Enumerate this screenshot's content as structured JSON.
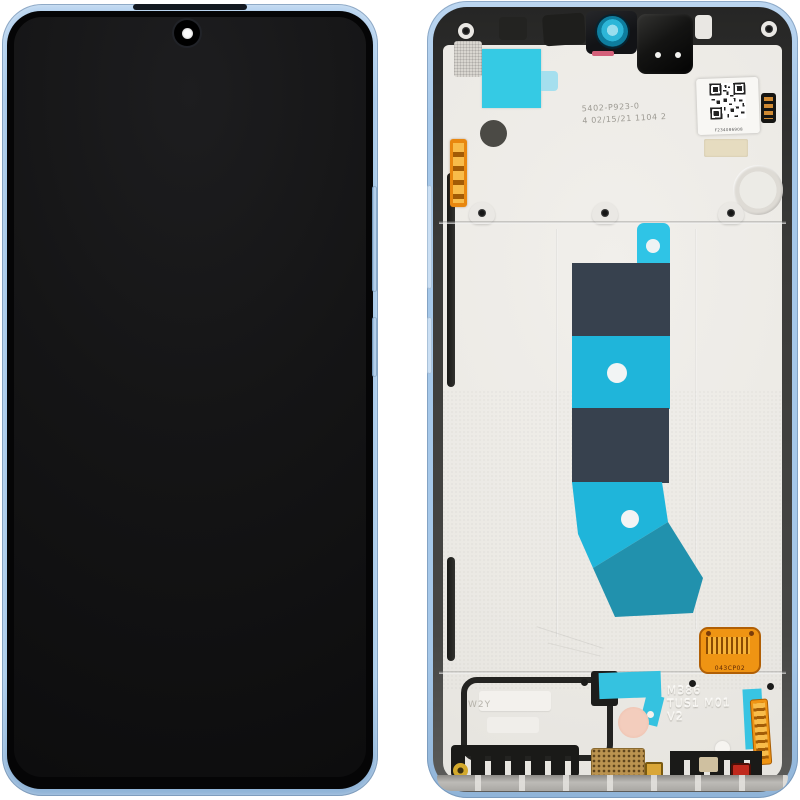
{
  "product": {
    "markings": {
      "etched_line1": "5402-P923-0",
      "etched_line2": "4 02/15/21 1104 2",
      "frame_code_line1": "M386",
      "frame_code_line2": "TUS1 M01",
      "frame_code_line3": "V2",
      "flex_code": "043CP02",
      "gasket_code": "W2Y",
      "qr_caption": "F234086908"
    },
    "colors": {
      "frame_blue": "#aac9e9",
      "tape_cyan": "#35cae4",
      "flex_navy": "#37414e",
      "flex_cyan": "#1fb5da",
      "flex_teal": "#2191ad",
      "connector_orange": "#ef9413",
      "plate_silver": "#edebe7",
      "screen_black": "#121212",
      "lens_cyan": "#2db6d8"
    }
  }
}
